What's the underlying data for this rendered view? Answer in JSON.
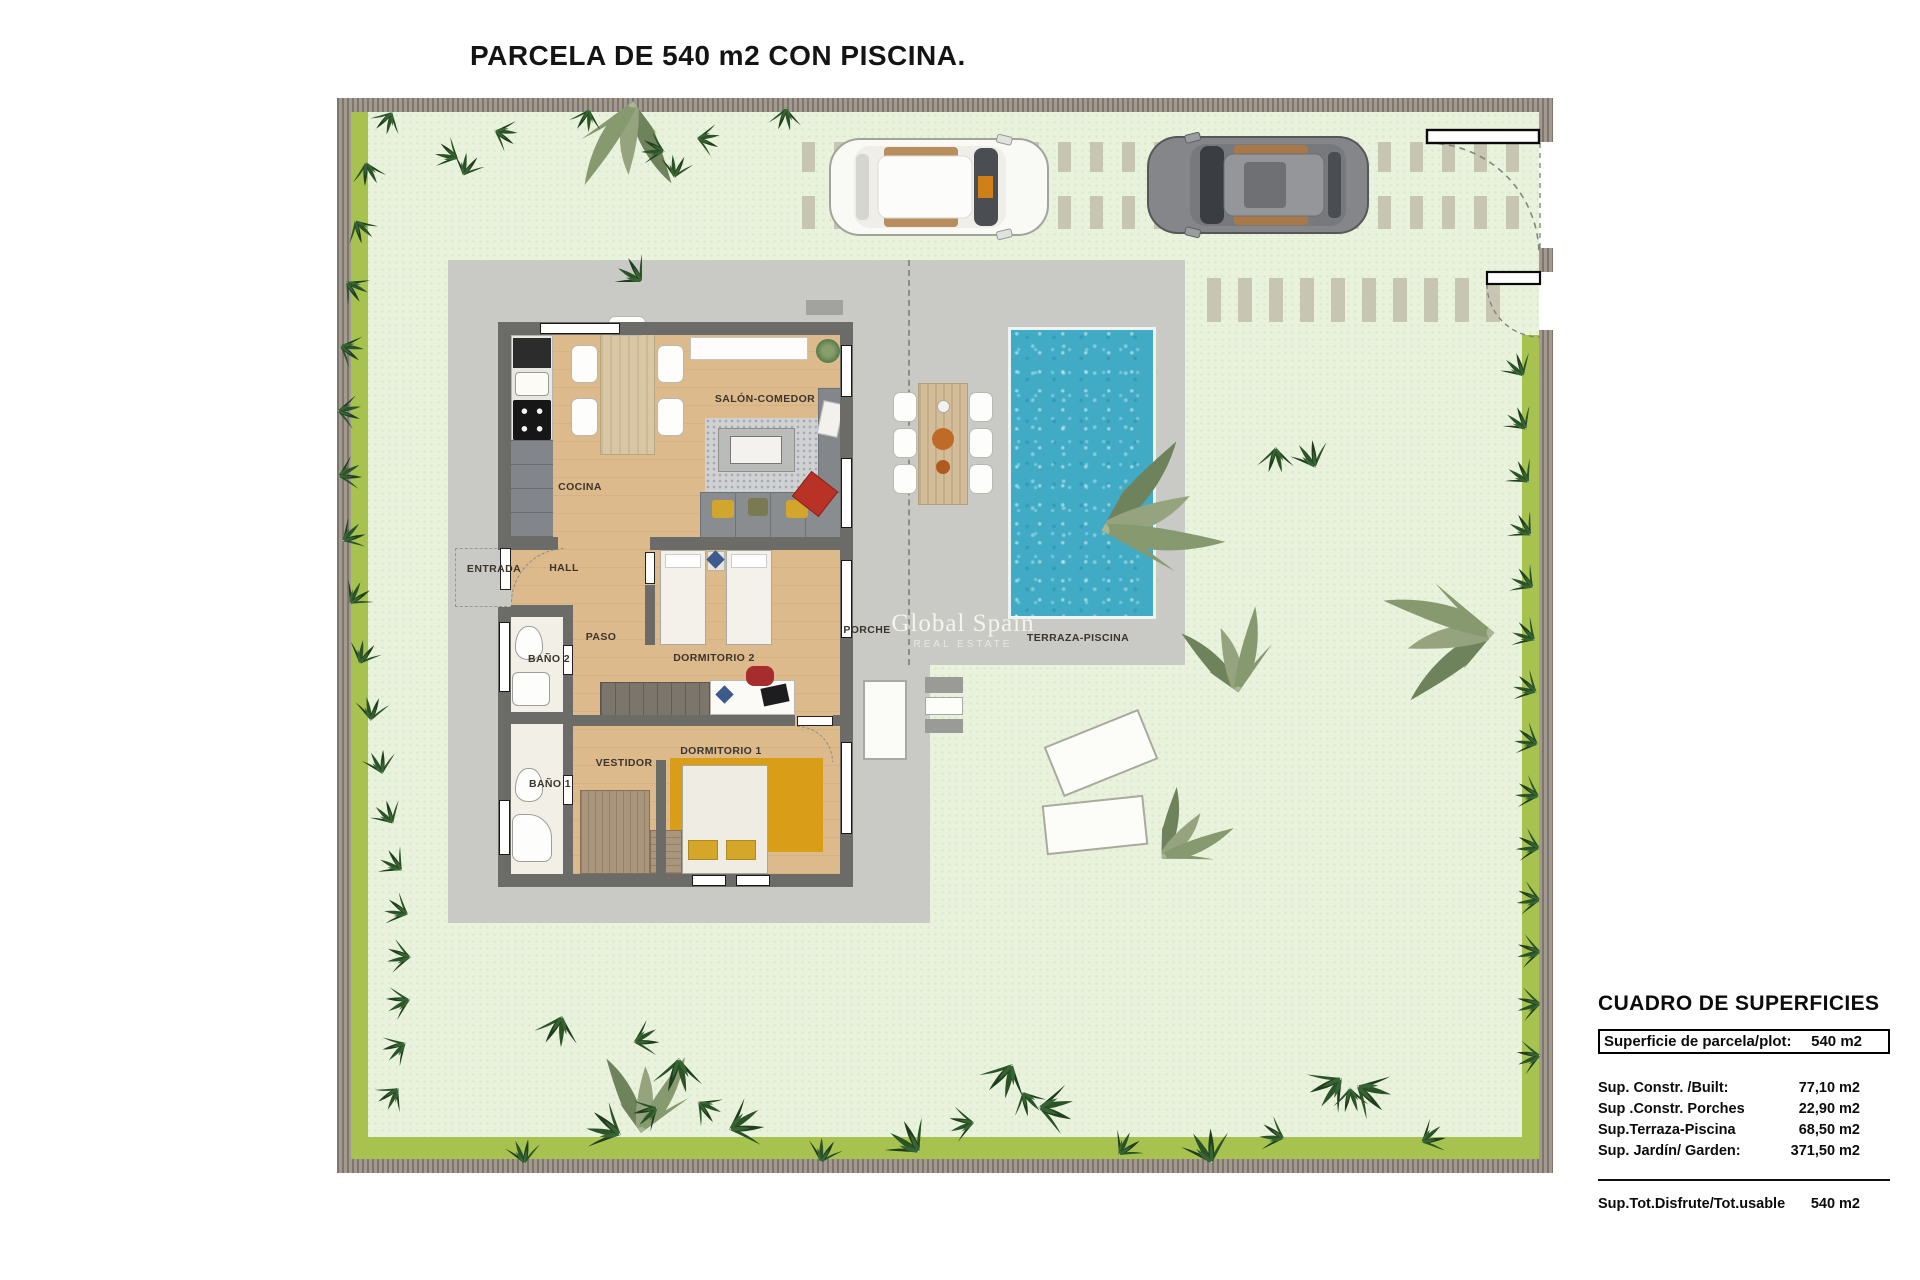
{
  "title": "PARCELA DE 540 m2 CON PISCINA.",
  "watermark": {
    "line1": "Global Spain",
    "line2": "REAL ESTATE"
  },
  "rooms": {
    "cocina": "COCINA",
    "salon": "SALÓN-COMEDOR",
    "entrada": "ENTRADA",
    "hall": "HALL",
    "paso": "PASO",
    "bano2": "BAÑO 2",
    "dormitorio2": "DORMITORIO 2",
    "vestidor": "VESTIDOR",
    "bano1": "BAÑO 1",
    "dormitorio1": "DORMITORIO 1",
    "porche": "PORCHE",
    "terraza": "TERRAZA-PISCINA"
  },
  "summary_table": {
    "title": "CUADRO DE SUPERFICIES",
    "header_row": {
      "label": "Superficie de parcela/plot:",
      "value": "540 m2"
    },
    "rows": [
      {
        "label": "Sup. Constr. /Built:",
        "value": "77,10 m2"
      },
      {
        "label": "Sup .Constr. Porches",
        "value": "22,90 m2"
      },
      {
        "label": "Sup.Terraza-Piscina",
        "value": "68,50 m2"
      },
      {
        "label": "Sup. Jardín/ Garden:",
        "value": "371,50 m2"
      }
    ],
    "total_row": {
      "label": "Sup.Tot.Disfrute/Tot.usable",
      "value": "540 m2"
    }
  },
  "colors": {
    "lawn": "#e9f2dc",
    "grass_strip": "#a7c24f",
    "boundary_wall": "#9a9287",
    "terrace_grey": "#c9c9c5",
    "house_wall": "#6b6b68",
    "wood_floor": "#dcba8c",
    "pool_blue": "#41abc6",
    "hedge_green": "#2b5328",
    "palm_olive": "#87996f",
    "accent_ochre": "#d99d18",
    "accent_red": "#b93226"
  }
}
